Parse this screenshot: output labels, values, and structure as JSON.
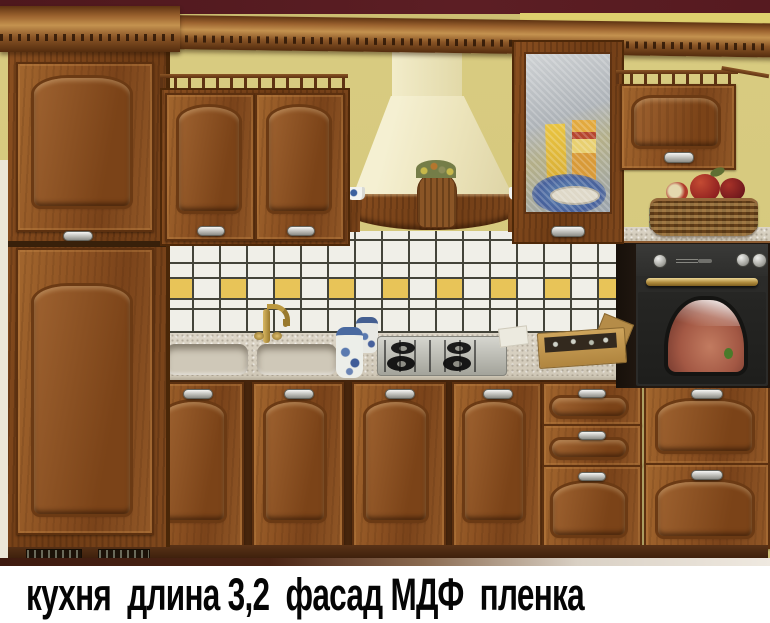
{
  "caption": {
    "text": "кухня  длина 3,2  фасад МДФ  пленка"
  },
  "palette": {
    "ceiling_trim_maroon": "#571c20",
    "wall_yellow": "#d6c97e",
    "cabinet_wood": "#8b5021",
    "wood_dark_edge": "#5c300f",
    "hood_cream": "#efe8c4",
    "tile_white": "#f0efe8",
    "tile_yellow_accent": "#e8c458",
    "tile_grout": "#44443a",
    "countertop_beige": "#d5cdbc",
    "oven_black": "#2b2b29",
    "brass": "#b08c3e",
    "plinth_brown": "#4a2a12",
    "caption_background": "#ffffff",
    "caption_text_color": "#000000"
  }
}
